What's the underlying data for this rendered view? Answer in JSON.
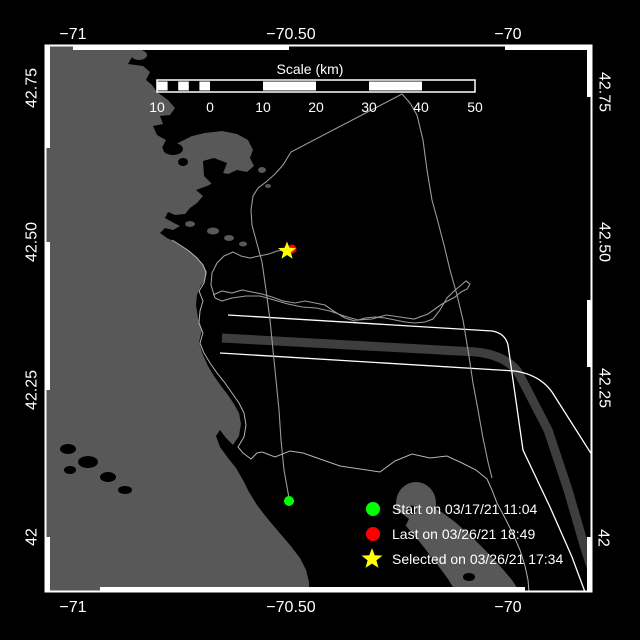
{
  "axis": {
    "lon": [
      {
        "label": "−71"
      },
      {
        "label": "−70.50"
      },
      {
        "label": "−70"
      }
    ],
    "lat": [
      {
        "label": "42.75"
      },
      {
        "label": "42.50"
      },
      {
        "label": "42.25"
      },
      {
        "label": "42"
      }
    ]
  },
  "scalebar": {
    "title": "Scale (km)",
    "tick_labels": [
      "10",
      "0",
      "10",
      "20",
      "30",
      "40",
      "50"
    ]
  },
  "legend": [
    {
      "label": "Start on 03/17/21 11:04",
      "marker": "circle",
      "color": "#00ff00"
    },
    {
      "label": "Last on 03/26/21 18:49",
      "marker": "circle",
      "color": "#ff0000"
    },
    {
      "label": "Selected on 03/26/21 17:34",
      "marker": "star",
      "color": "#ffff00"
    }
  ],
  "colors": {
    "background": "#000000",
    "land": "#585858",
    "separation_zone": "#3e3e3e",
    "track": "#9a9a9a",
    "coastline": "#b4b4b4",
    "frame": "#ffffff",
    "start": "#00ff00",
    "last": "#ff0000",
    "selected": "#ffff00"
  }
}
